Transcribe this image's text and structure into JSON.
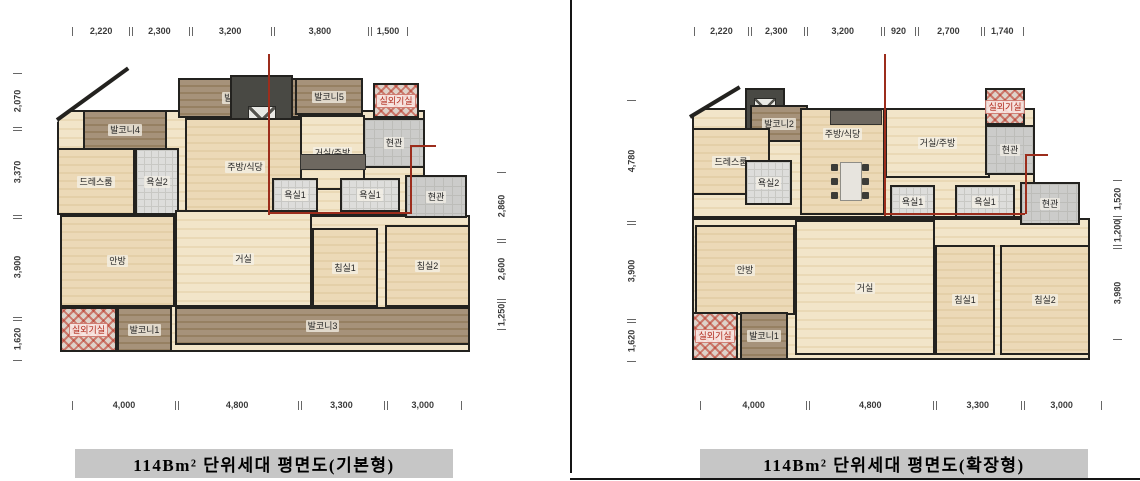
{
  "colors": {
    "wall": "#23221f",
    "wood_floor": "#e9d6b0",
    "balcony": "#9c8768",
    "tile": "#dddddb",
    "red_boundary": "#9c2d1c",
    "outdoor_unit_red": "#b02b1d",
    "caption_bg": "#c6c6c6"
  },
  "plans": [
    {
      "caption": "114Bm² 단위세대 평면도(기본형)",
      "top_dims": [
        "2,220",
        "2,300",
        "3,200",
        "3,800",
        "1,500"
      ],
      "left_dims": [
        "2,070",
        "3,370",
        "3,900",
        "1,620"
      ],
      "right_dims": [
        "2,860",
        "2,600",
        "1,250"
      ],
      "bottom_dims": [
        "4,000",
        "4,800",
        "3,300",
        "3,000"
      ],
      "rooms": {
        "balcony4": "발코니4",
        "balcony2": "발코니2",
        "balcony5": "발코니5",
        "outdoor_top": "실외기실",
        "entry_upper": "현관",
        "dress": "드레스룸",
        "bath2": "욕실2",
        "kitchen": "주방/식당",
        "living_kitchen": "거실/주방",
        "bath1a": "욕실1",
        "bath1b": "욕실1",
        "entry_lower": "현관",
        "master": "안방",
        "living": "거실",
        "bed1": "침실1",
        "bed2": "침실2",
        "outdoor_bottom": "실외기실",
        "balcony1": "발코니1",
        "balcony3": "발코니3"
      }
    },
    {
      "caption": "114Bm² 단위세대 평면도(확장형)",
      "top_dims": [
        "2,220",
        "2,300",
        "3,200",
        "920",
        "2,700",
        "1,740"
      ],
      "left_dims": [
        "4,780",
        "3,900",
        "1,620"
      ],
      "right_dims": [
        "1,520",
        "1,200",
        "3,980"
      ],
      "bottom_dims": [
        "4,000",
        "4,800",
        "3,300",
        "3,000"
      ],
      "rooms": {
        "balcony2": "발코니2",
        "outdoor_top": "실외기실",
        "entry_upper": "현관",
        "dress": "드레스룸",
        "bath2": "욕실2",
        "kitchen": "주방/식당",
        "living_kitchen": "거실/주방",
        "bath1a": "욕실1",
        "bath1b": "욕실1",
        "entry_lower": "현관",
        "master": "안방",
        "living": "거실",
        "bed1": "침실1",
        "bed2": "침실2",
        "outdoor_bottom": "실외기실",
        "balcony1": "발코니1"
      }
    }
  ]
}
